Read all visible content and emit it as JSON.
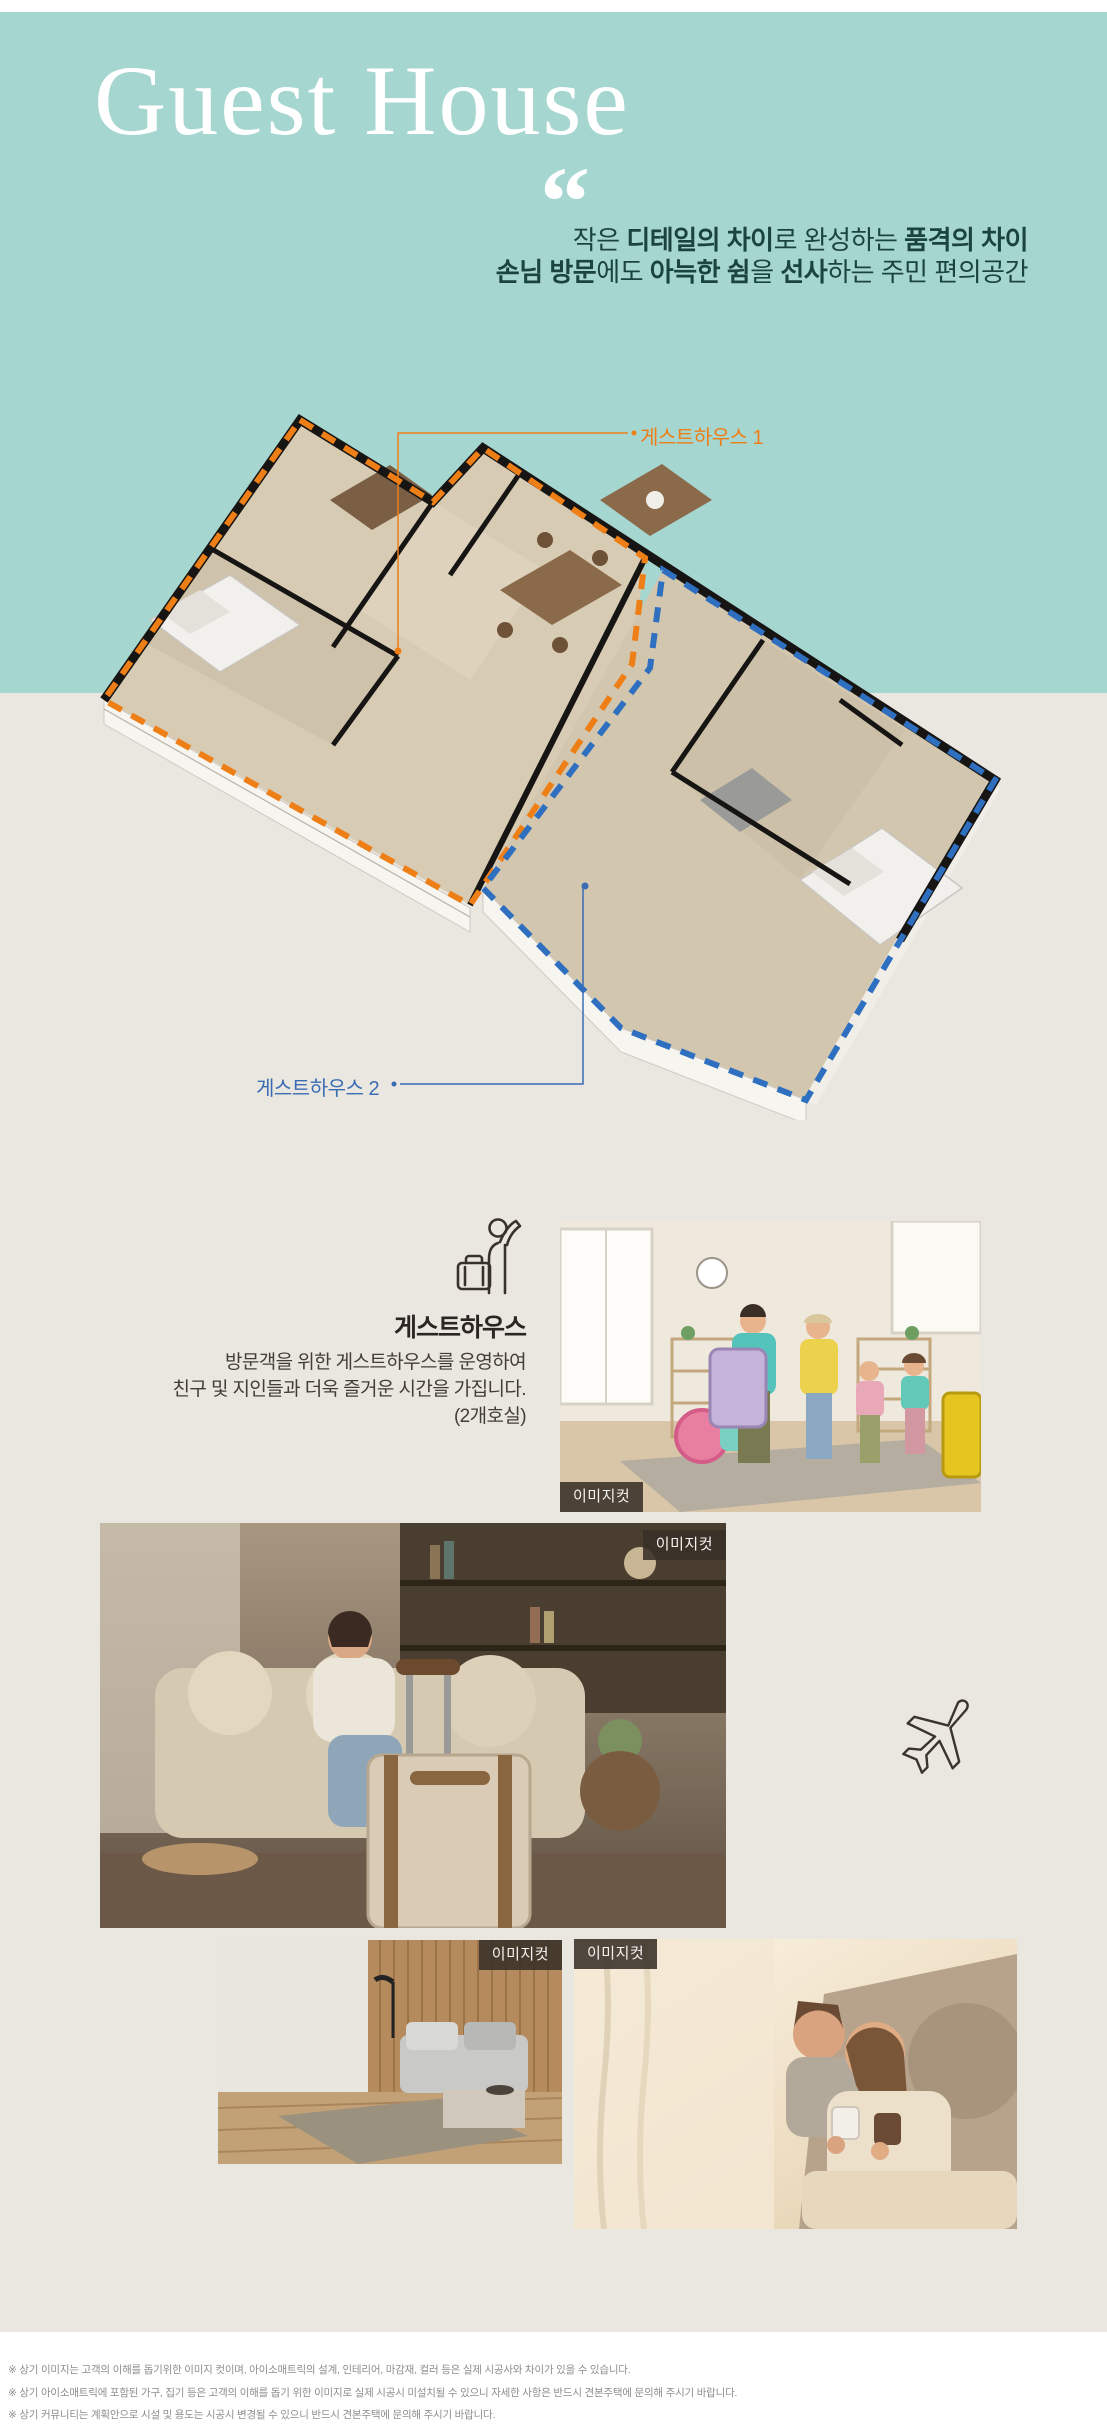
{
  "colors": {
    "teal_bg": "#a6d6d0",
    "beige_bg": "#e9e7e0",
    "dark_teal_text": "#1b4441",
    "orange_accent": "#ee7f17",
    "blue_accent": "#2e6fc0",
    "blue_label": "#3a6cb4",
    "badge_bg": "#383028",
    "footer_gray": "#8e8e8e"
  },
  "hero": {
    "title": "Guest House",
    "quote_mark": "“",
    "line1": [
      "작은 ",
      "디테일의 차이",
      "로 완성하는 ",
      "품격의 차이"
    ],
    "line2": [
      "손님 방문",
      "에도 ",
      "아늑한 쉼",
      "을 ",
      "선사",
      "하는 주민 편의공간"
    ]
  },
  "floorplan": {
    "label1": "게스트하우스 1",
    "label2": "게스트하우스 2"
  },
  "feature": {
    "icon": "waving-person-with-suitcase-icon",
    "heading": "게스트하우스",
    "line1": "방문객을 위한 게스트하우스를 운영하여",
    "line2": "친구 및 지인들과 더욱 즐거운 시간을 가집니다.",
    "line3": "(2개호실)"
  },
  "badges": {
    "image_cut": "이미지컷"
  },
  "icons": {
    "airplane": "airplane-icon"
  },
  "footer": {
    "line1": "※ 상기 이미지는 고객의 이해를 돕기위한 이미지 컷이며, 아이소매트릭의 설계, 인테리어, 마감재, 컬러 등은 실제 시공사와 차이가 있을 수 있습니다.",
    "line2": "※ 상기 아이소매트릭에 포함된 가구, 집기 등은 고객의 이해를 돕기 위한 이미지로 실제 시공시 미설치될 수 있으니 자세한 사항은 반드시 견본주택에 문의해 주시기 바랍니다.",
    "line3": "※ 상기 커뮤니티는 계획안으로 시설 및 용도는 시공시 변경될 수 있으니 반드시 견본주택에 문의해 주시기 바랍니다."
  }
}
